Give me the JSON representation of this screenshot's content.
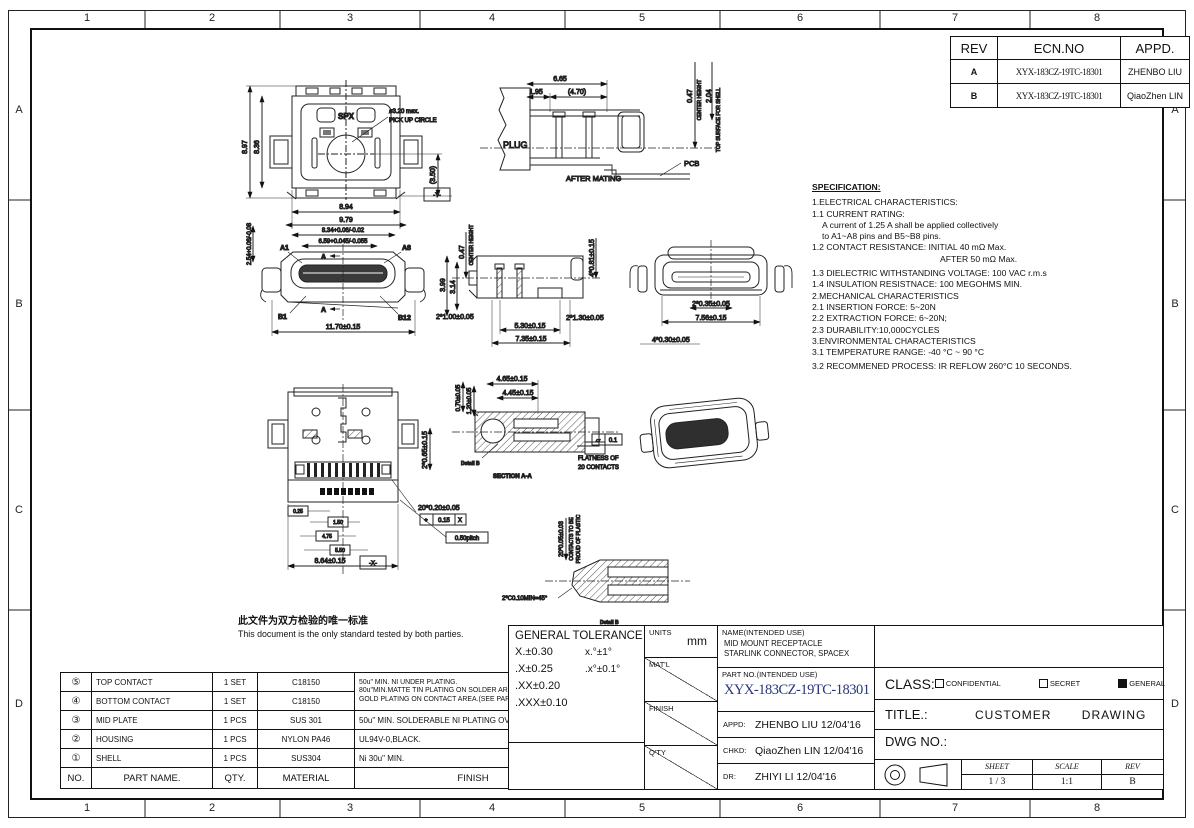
{
  "frame": {
    "cols": [
      "1",
      "2",
      "3",
      "4",
      "5",
      "6",
      "7",
      "8"
    ],
    "rows": [
      "A",
      "B",
      "C",
      "D"
    ]
  },
  "colors": {
    "part_no_blue": "#25357e",
    "detail_label_red": "#8a2a2a"
  },
  "revision_table": {
    "headers": [
      "REV",
      "ECN.NO",
      "APPD."
    ],
    "rows": [
      {
        "rev": "A",
        "ecn": "XYX-183CZ-19TC-18301",
        "appd": "ZHENBO LIU"
      },
      {
        "rev": "B",
        "ecn": "XYX-183CZ-19TC-18301",
        "appd": "QiaoZhen LIN"
      }
    ]
  },
  "specification": {
    "title": "SPECIFICATION:",
    "lines": [
      "1.ELECTRICAL CHARACTERISTICS:",
      "1.1 CURRENT RATING:",
      "A current of 1.25 A shall be applied collectively",
      "to A1~A8 pins and B5~B8 pins.",
      "1.2 CONTACT RESISTANCE: INITIAL 40 mΩ Max.",
      "AFTER 50 mΩ Max.",
      "1.3 DIELECTRIC WITHSTANDING VOLTAGE: 100 VAC r.m.s",
      "1.4 INSULATION RESISTNACE: 100 MEGOHMS MIN.",
      "2.MECHANICAL CHARACTERISTICS",
      "2.1 INSERTION FORCE: 5~20N",
      "2.2 EXTRACTION FORCE: 6~20N;",
      "2.3 DURABILITY:10,000CYCLES",
      "3.ENVIRONMENTAL CHARACTERISTICS",
      "3.1 TEMPERATURE RANGE: -40 °C ~ 90 °C",
      "3.2 RECOMMENED PROCESS: IR REFLOW 260°C 10 SECONDS."
    ]
  },
  "notes": {
    "cn": "此文件为双方检验的唯一标准",
    "en": "This document is the only standard tested by both parties."
  },
  "parts_table": {
    "headers": {
      "no": "NO.",
      "name": "PART NAME.",
      "qty": "QTY.",
      "material": "MATERIAL",
      "finish": "FINISH"
    },
    "rows": [
      {
        "no": "⑤",
        "name": "TOP CONTACT",
        "qty": "1 SET",
        "material": "C18150"
      },
      {
        "no": "④",
        "name": "BOTTOM CONTACT",
        "qty": "1 SET",
        "material": "C18150"
      },
      {
        "no": "③",
        "name": "MID PLATE",
        "qty": "1 PCS",
        "material": "SUS 301",
        "finish": "50u\" MIN. SOLDERABLE NI PLATING OVERALL."
      },
      {
        "no": "②",
        "name": "HOUSING",
        "qty": "1 PCS",
        "material": "NYLON PA46",
        "finish": "UL94V-0,BLACK."
      },
      {
        "no": "①",
        "name": "SHELL",
        "qty": "1 PCS",
        "material": "SUS304",
        "finish": "Ni 30u\" MIN."
      }
    ],
    "contact_finish": [
      "50u\" MIN. NI UNDER PLATING.",
      "80u\"MIN.MATTE TIN PLATING ON SOLDER AREA.",
      "GOLD PLATING ON CONTACT AREA.(SEE PART MUM)"
    ]
  },
  "title_block": {
    "general_tolerance": {
      "title": "GENERAL TOLERANCE",
      "col1": [
        "X.±0.30",
        ".X±0.25",
        ".XX±0.20",
        ".XXX±0.10"
      ],
      "col2": [
        "x.°±1°",
        ".x°±0.1°"
      ]
    },
    "units_label": "UNITS",
    "units_value": "mm",
    "matl_label": "MAT'L",
    "finish_label": "FINISH",
    "qty_label": "Q'TY",
    "name_label": "NAME(INTENDED USE)",
    "name_lines": [
      "MID MOUNT RECEPTACLE",
      "STARLINK CONNECTOR, SPACEX"
    ],
    "part_no_label": "PART NO.(INTENDED USE)",
    "part_no": "XYX-183CZ-19TC-18301",
    "appd_label": "APPD:",
    "appd_value": "ZHENBO LIU 12/04'16",
    "chkd_label": "CHKD:",
    "chkd_value": "QiaoZhen LIN 12/04'16",
    "dr_label": "DR:",
    "dr_value": "ZHIYI LI 12/04'16",
    "class_label": "CLASS:",
    "class_options": [
      {
        "label": "CONFIDENTIAL",
        "checked": false
      },
      {
        "label": "SECRET",
        "checked": false
      },
      {
        "label": "GENERAL",
        "checked": true
      }
    ],
    "title_label": "TITLE.:",
    "title_value": "CUSTOMER DRAWING",
    "dwg_label": "DWG NO.:",
    "sheet_label": "SHEET",
    "sheet_value": "1 / 3",
    "scale_label": "SCALE",
    "scale_value": "1:1",
    "rev_label": "REV",
    "rev_value": "B"
  },
  "views": {
    "top": {
      "h1": "8.97",
      "h2": "8.36",
      "w1": "8.94",
      "w2": "9.79",
      "ref": "(3.50)",
      "callout1": "ø3.20 max.",
      "callout2": "PICK UP CIRCLE",
      "marking": "SPX",
      "datum": "-Y-"
    },
    "mating": {
      "d_total": "6.65",
      "d_offset": "1.95",
      "d_ref": "(4.70)",
      "d_center": "0.47",
      "center_label": "CENTER HEIGHT",
      "d_top": "2.04",
      "top_label": "TOP SURFACE FOR SHELL",
      "plug": "PLUG",
      "caption": "AFTER MATING",
      "pcb": "PCB"
    },
    "front": {
      "d_left": "2.54+0.06/-0.08",
      "d_w1": "8.34+0.06/-0.02",
      "d_w2": "6.59+0.045/-0.055",
      "a1": "A1",
      "a8": "A8",
      "b1": "B1",
      "b12": "B12",
      "d_total": "11.70±0.15",
      "sec": "A"
    },
    "side": {
      "d_center": "0.47",
      "center_label": "CENTER HEIGHT",
      "d_h1": "3.99",
      "d_h2": "3.14",
      "d_posts": "2*1.00±0.05",
      "d_tails": "4*0.81±0.15",
      "d_legs": "2*1.30±0.05",
      "d_w1": "5.30±0.15",
      "d_w2": "7.35±0.15"
    },
    "rear": {
      "d1": "2*0.35±0.05",
      "d2": "7.56±0.15",
      "d3": "4*0.30±0.05"
    },
    "bottom": {
      "d_side": "2*0.65±0.15",
      "d_pins": "20*0.20±0.05",
      "fcf_sym": "⌖",
      "fcf_val": "0.15",
      "fcf_datum": "X",
      "pitch": "0.50pitch",
      "b1": "0.25",
      "b2": "1.50",
      "b3": "4.75",
      "b4": "5.50",
      "d_w": "8.64±0.15",
      "datum": "-X-"
    },
    "section": {
      "d_v1": "0.70±0.05",
      "d_v2": "1.20±0.05",
      "d_t1": "4.65±0.15",
      "d_t2": "4.45±0.15",
      "flat_sym": "▱",
      "flat_val": "0.1",
      "flat_l1": "FLATNESS OF",
      "flat_l2": "20 CONTACTS",
      "detail_label": "Detail B",
      "name": "SECTION A-A"
    },
    "detail": {
      "d1": "20*0.05±0.03",
      "n1": "CONTACTS TO BE",
      "n2": "PROUD OF PLASTIC",
      "chamfer": "2*C0.10MIN=45°",
      "name": "Detail B"
    }
  }
}
